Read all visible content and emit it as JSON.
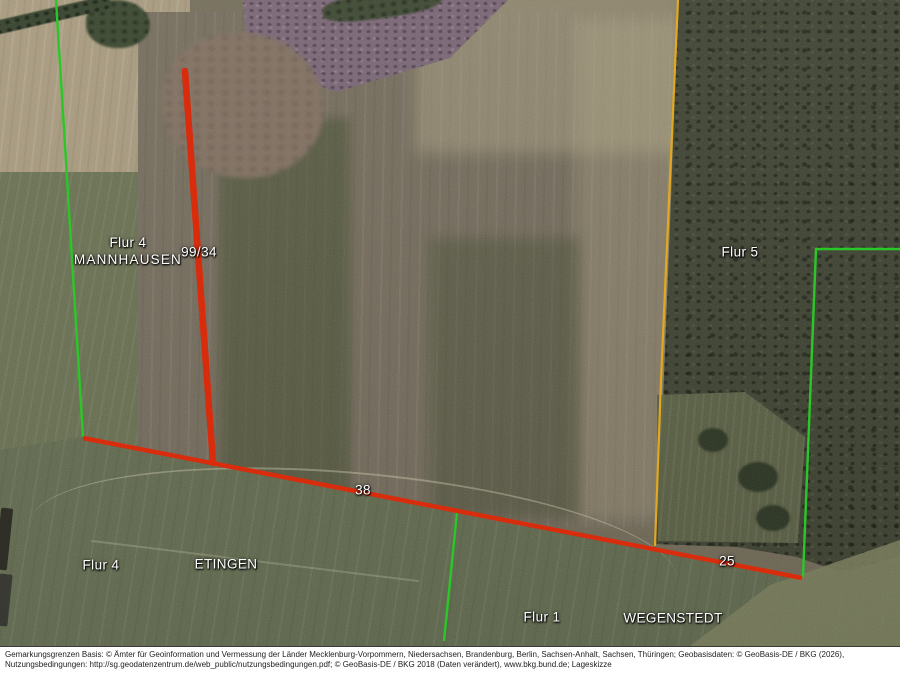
{
  "document_type": "Lageskizze",
  "map": {
    "labels": {
      "flur4_north": "Flur 4",
      "gemarkung_mannhausen": "MANNHAUSEN",
      "parcel_99_34": "99/34",
      "flur5": "Flur 5",
      "flur4_south": "Flur 4",
      "gemarkung_etingen": "ETINGEN",
      "segment_38": "38",
      "segment_25": "25",
      "flur1": "Flur 1",
      "gemarkung_wegenstedt": "WEGENSTEDT"
    },
    "colors": {
      "parcel_boundary_red": "#d92c0c",
      "gemarkung_boundary_green": "#2bc728",
      "flur_boundary_orange": "#e2a81f"
    }
  },
  "footer": {
    "line1": "Gemarkungsgrenzen Basis: © Ämter für Geoinformation und Vermessung der Länder Mecklenburg-Vorpommern, Niedersachsen, Brandenburg, Berlin, Sachsen-Anhalt, Sachsen, Thüringen; Geobasisdaten: © GeoBasis-DE / BKG (2026),",
    "line2": "Nutzungsbedingungen: http://sg.geodatenzentrum.de/web_public/nutzungsbedingungen.pdf; © GeoBasis-DE / BKG 2018 (Daten verändert), www.bkg.bund.de; Lageskizze"
  }
}
